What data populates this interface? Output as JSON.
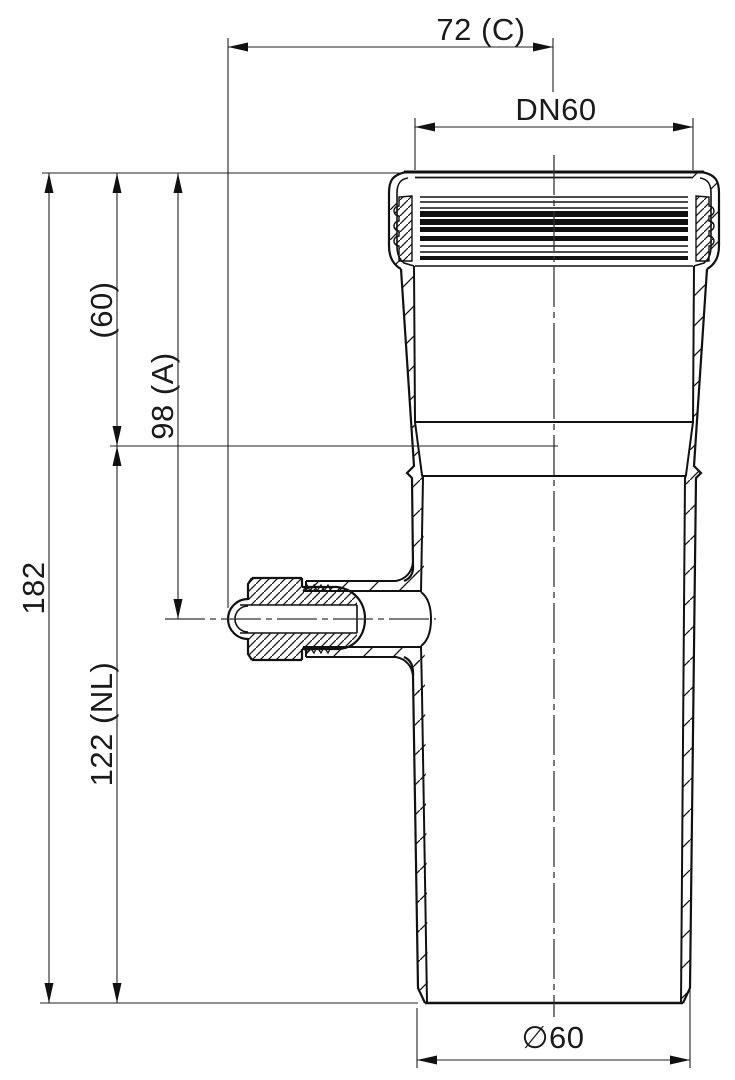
{
  "drawing": {
    "kind": "technical section drawing of a DN60 pipe fitting with push-fit socket and side measuring port plug",
    "background_color": "#ffffff",
    "line_color": "#1a1a1a",
    "labels": {
      "port_offset": "72 (C)",
      "socket_diameter": "DN60",
      "overall_length": "182",
      "socket_depth": "(60)",
      "port_height": "98 (A)",
      "body_length": "122 (NL)",
      "outlet_diameter": "∅60"
    },
    "dimension_list": [
      {
        "name": "port_offset",
        "label": "72 (C)",
        "orientation": "horizontal",
        "position": "top"
      },
      {
        "name": "socket_diameter",
        "label": "DN60",
        "orientation": "horizontal",
        "position": "top"
      },
      {
        "name": "overall_length",
        "label": "182",
        "orientation": "vertical",
        "position": "left"
      },
      {
        "name": "socket_depth",
        "label": "(60)",
        "orientation": "vertical",
        "position": "left"
      },
      {
        "name": "port_height",
        "label": "98 (A)",
        "orientation": "vertical",
        "position": "left"
      },
      {
        "name": "body_length",
        "label": "122 (NL)",
        "orientation": "vertical",
        "position": "left"
      },
      {
        "name": "outlet_diameter",
        "label": "∅60",
        "orientation": "horizontal",
        "position": "bottom"
      }
    ]
  }
}
